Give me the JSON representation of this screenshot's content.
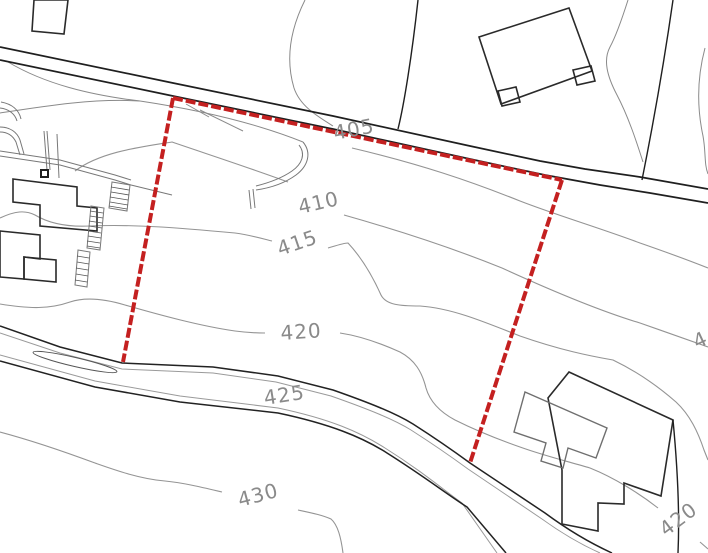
{
  "drawing": {
    "type": "site-plan-topographic-survey",
    "background_color": "#ffffff",
    "line_colors": {
      "boundary_red": "#c42020",
      "contour_gray": "#949494",
      "detail_black": "#1f1f1f"
    }
  },
  "contour_labels": [
    {
      "id": "405",
      "text": "405",
      "x": 335,
      "y": 140,
      "rotation": -11
    },
    {
      "id": "410",
      "text": "410",
      "x": 300,
      "y": 214,
      "rotation": -13
    },
    {
      "id": "415",
      "text": "415",
      "x": 280,
      "y": 256,
      "rotation": -19
    },
    {
      "id": "420",
      "text": "420",
      "x": 281,
      "y": 340,
      "rotation": -4
    },
    {
      "id": "425",
      "text": "425",
      "x": 265,
      "y": 405,
      "rotation": -9
    },
    {
      "id": "430",
      "text": "430",
      "x": 240,
      "y": 507,
      "rotation": -15
    },
    {
      "id": "420-east",
      "text": "420",
      "x": 666,
      "y": 537,
      "rotation": -37
    },
    {
      "id": "edge-partial",
      "text": "4",
      "x": 697,
      "y": 349,
      "rotation": -25
    }
  ],
  "contour_elevations_visible": [
    405,
    410,
    415,
    420,
    425,
    430
  ],
  "plot_boundary": {
    "color": "#c42020",
    "style": "dashed",
    "segments": [
      {
        "name": "north-leg-along-road",
        "from": [
          173,
          98
        ],
        "to": [
          562,
          180
        ]
      },
      {
        "name": "west-leg",
        "from": [
          173,
          98
        ],
        "to": [
          123,
          362
        ]
      },
      {
        "name": "east-leg",
        "from": [
          562,
          180
        ],
        "to": [
          470,
          463
        ]
      }
    ]
  }
}
